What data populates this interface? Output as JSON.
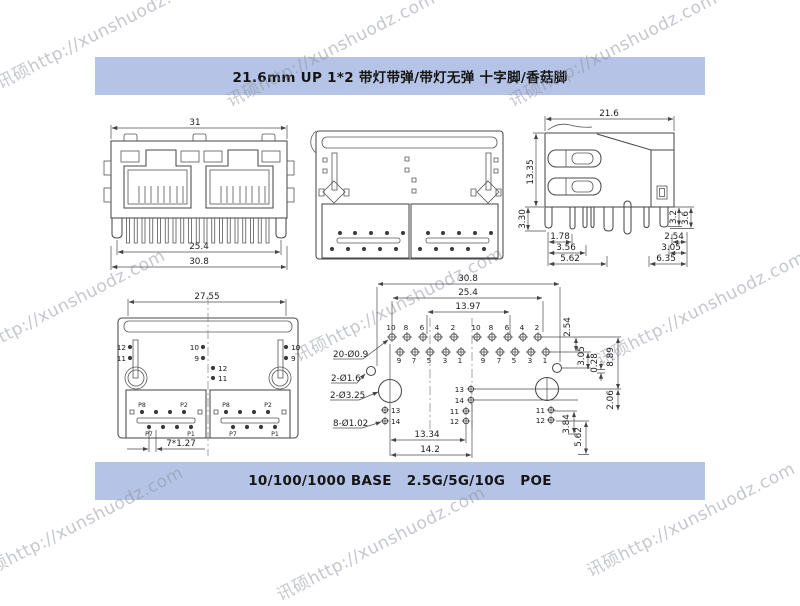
{
  "watermark": {
    "text": "讯硕http://xunshuodz.com"
  },
  "banners": {
    "top": "21.6mm UP 1*2 带灯带弹/带灯无弹 十字脚/香菇脚",
    "bottom": "10/100/1000 BASE   2.5G/5G/10G   POE",
    "bg_color": "#b5c4e6"
  },
  "views": {
    "front": {
      "dim_top": "31",
      "dim_pins": "25.4",
      "dim_body": "30.8"
    },
    "side": {
      "dim_width": "21.6",
      "dim_height": "13.35",
      "dim_pin_len": "3.30",
      "left_dims": [
        "1.78",
        "3.56",
        "5.62"
      ],
      "right_dims": [
        "2.54",
        "3.05",
        "6.35"
      ],
      "right_v_dims": [
        "3.2",
        "3.6"
      ]
    },
    "bottom": {
      "dim_width": "27.55",
      "dim_pitch": "7*1.27",
      "left_pins": [
        "12",
        "11"
      ],
      "mid_top_pins": [
        "10",
        "9"
      ],
      "mid_low_pins": [
        "12",
        "11"
      ],
      "right_pins": [
        "10",
        "9"
      ],
      "pad_labels": [
        "P8",
        "P2",
        "P7",
        "P1"
      ]
    },
    "footprint": {
      "dim_w1": "30.8",
      "dim_w2": "25.4",
      "dim_w3": "13.97",
      "dim_b1": "13.34",
      "dim_b2": "14.2",
      "v1": "2.54",
      "v2": "3.05",
      "v3": "0.28",
      "v4": "8.89",
      "v5": "2.06",
      "v6": "3.84",
      "v7": "5.62",
      "callout_pads": "20-Ø0.9",
      "callout_leds": "2-Ø1.6",
      "callout_posts": "2-Ø3.25",
      "callout_holes": "8-Ø1.02",
      "top_row": [
        "10",
        "8",
        "6",
        "4",
        "2"
      ],
      "bottom_row": [
        "9",
        "7",
        "5",
        "3",
        "1"
      ],
      "led_left": [
        "13",
        "14"
      ],
      "led_mid": [
        "13",
        "14",
        "11",
        "12"
      ],
      "led_right": [
        "11",
        "12"
      ]
    }
  }
}
